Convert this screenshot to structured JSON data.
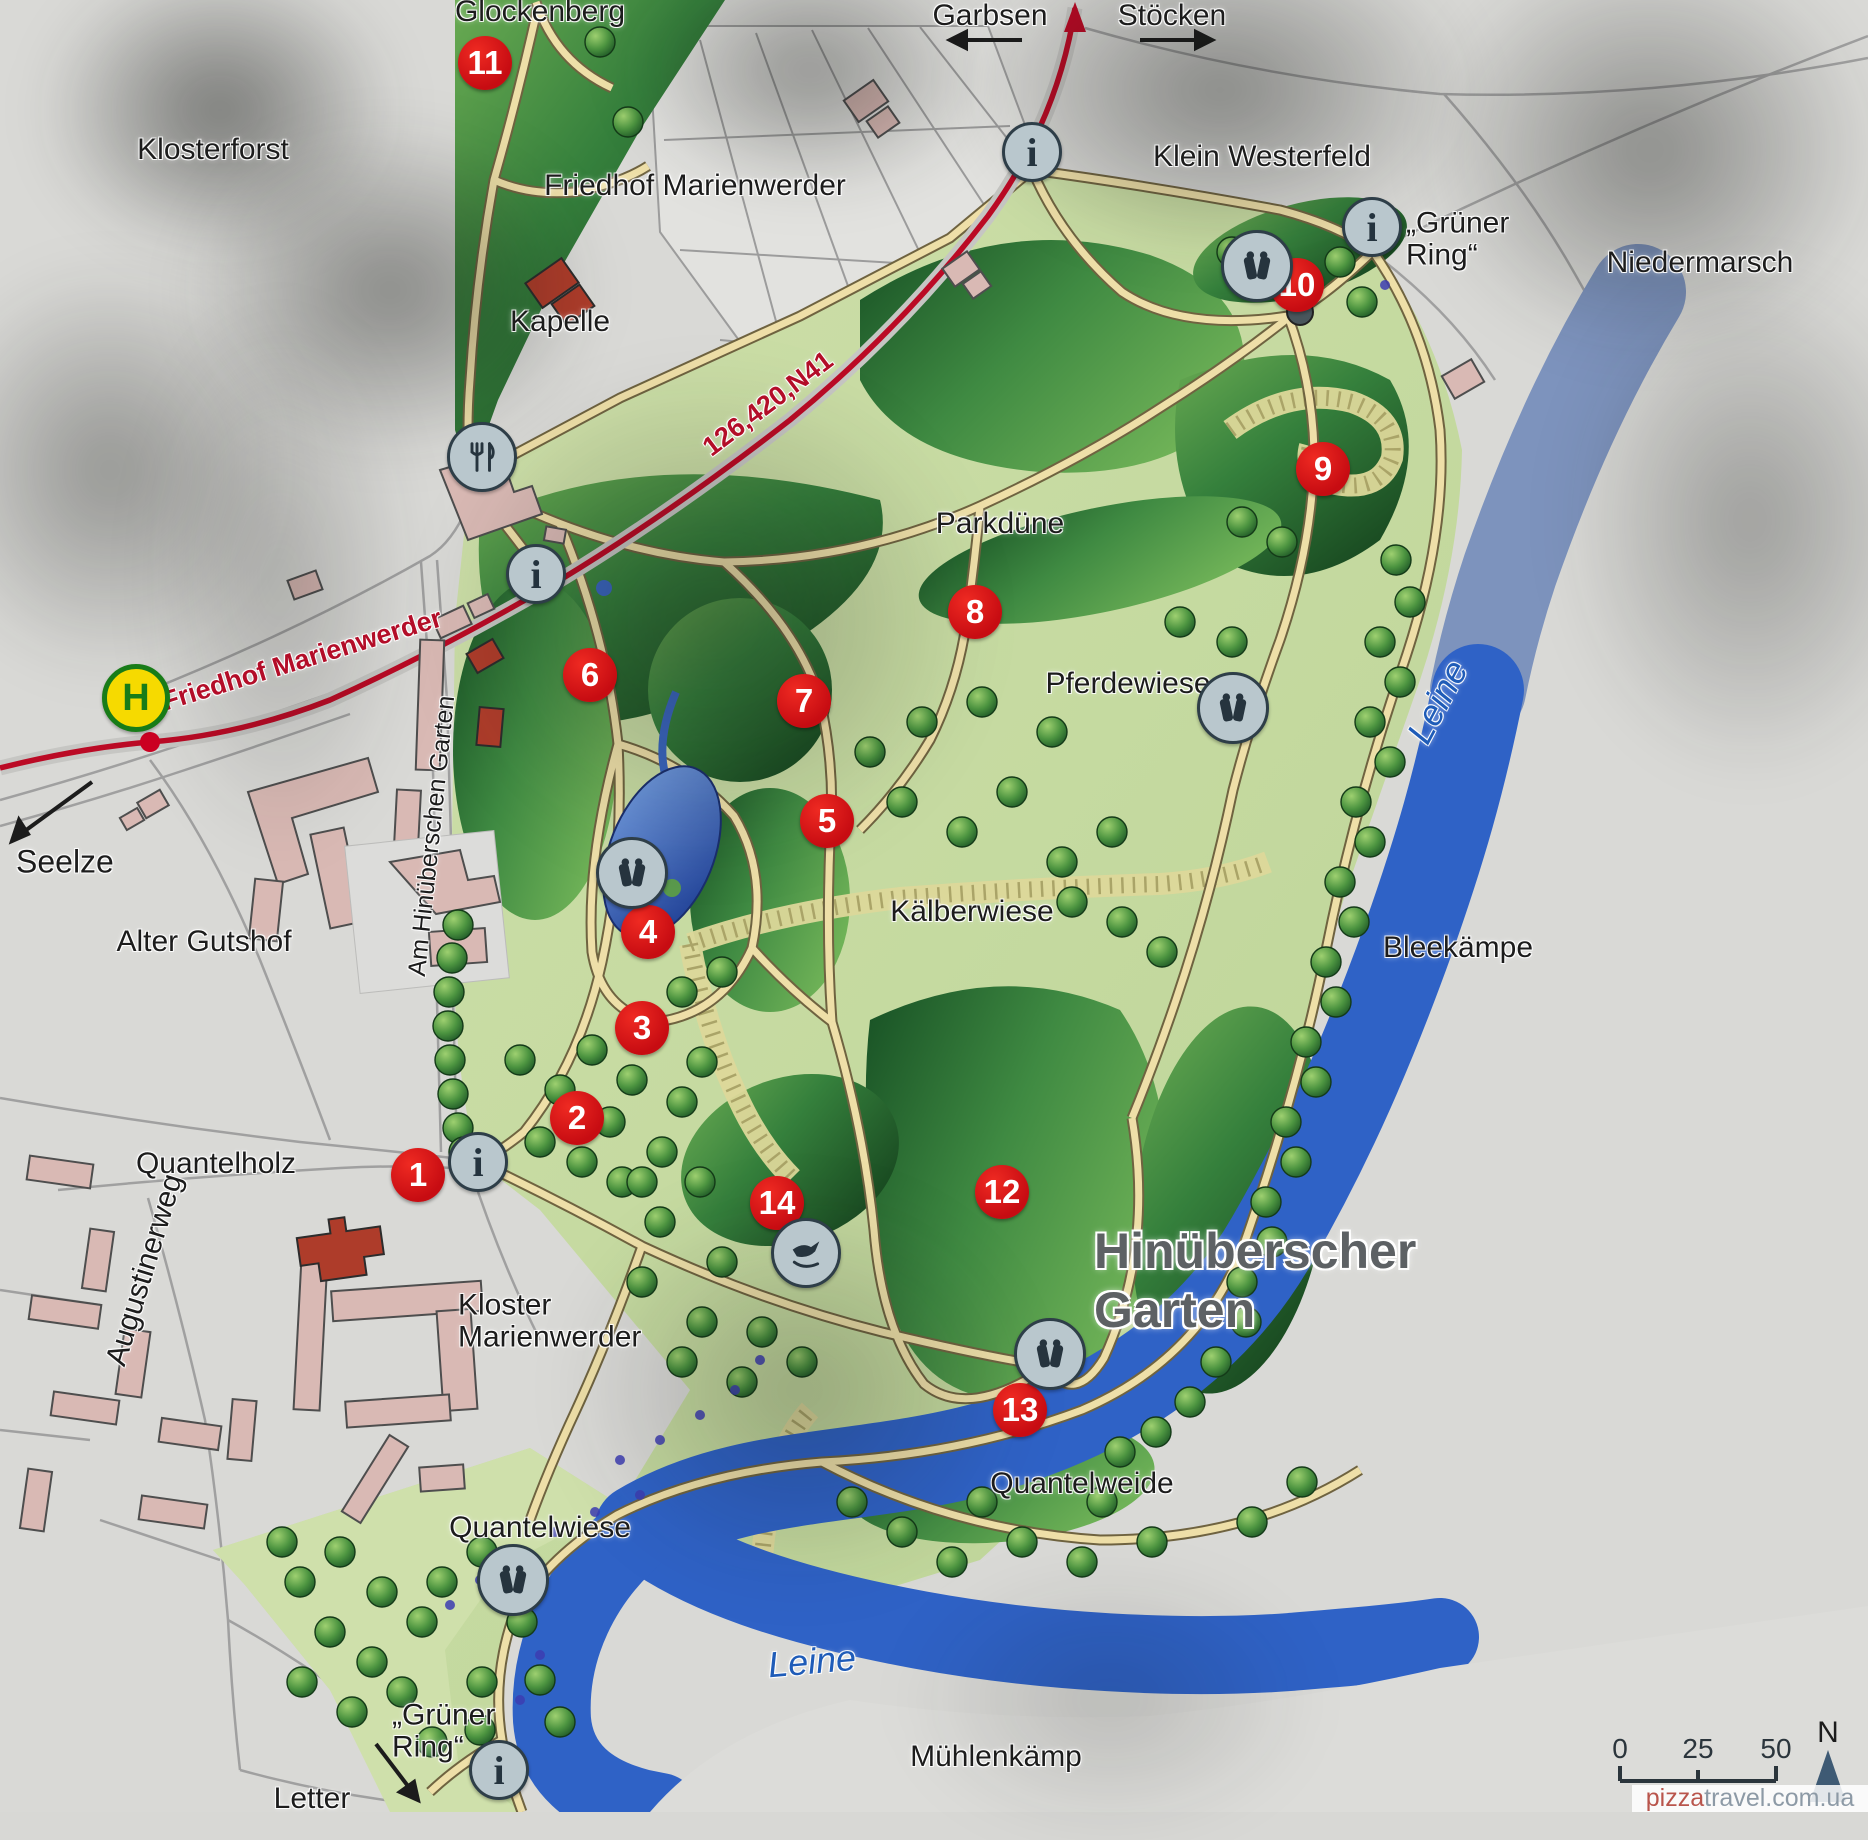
{
  "sign": {
    "title_line1": "Hinüberscher",
    "title_line2": "Garten"
  },
  "labels": [
    {
      "id": "glockenberg",
      "text": "Glockenberg",
      "x": 540,
      "y": 12
    },
    {
      "id": "klosterforst",
      "text": "Klosterforst",
      "x": 213,
      "y": 150
    },
    {
      "id": "friedhof-marienwerder-area",
      "text": "Friedhof Marienwerder",
      "x": 695,
      "y": 186
    },
    {
      "id": "kapelle",
      "text": "Kapelle",
      "x": 560,
      "y": 322
    },
    {
      "id": "garbsen",
      "text": "Garbsen",
      "x": 990,
      "y": 16
    },
    {
      "id": "stoecken",
      "text": "Stöcken",
      "x": 1172,
      "y": 16
    },
    {
      "id": "klein-westerfeld",
      "text": "Klein Westerfeld",
      "x": 1262,
      "y": 157
    },
    {
      "id": "gruener-ring-north",
      "text": "„Grüner\nRing“",
      "x": 1406,
      "y": 240,
      "align": "left"
    },
    {
      "id": "niedermarsch",
      "text": "Niedermarsch",
      "x": 1700,
      "y": 263
    },
    {
      "id": "parkduene",
      "text": "Parkdüne",
      "x": 1000,
      "y": 524
    },
    {
      "id": "pferdewiese",
      "text": "Pferdewiese",
      "x": 1128,
      "y": 684
    },
    {
      "id": "kaelberwiese",
      "text": "Kälberwiese",
      "x": 972,
      "y": 912
    },
    {
      "id": "bleekaempe",
      "text": "Bleekämpe",
      "x": 1458,
      "y": 948
    },
    {
      "id": "leine-east",
      "text": "Leine",
      "x": 1438,
      "y": 702,
      "cls": "water",
      "rot": -62
    },
    {
      "id": "leine-south",
      "text": "Leine",
      "x": 812,
      "y": 1662,
      "cls": "water",
      "rot": -5
    },
    {
      "id": "quantelweide",
      "text": "Quantelweide",
      "x": 1082,
      "y": 1484
    },
    {
      "id": "quantelwiese",
      "text": "Quantelwiese",
      "x": 540,
      "y": 1528
    },
    {
      "id": "gruener-ring-south",
      "text": "„Grüner\nRing“",
      "x": 392,
      "y": 1732,
      "align": "left"
    },
    {
      "id": "letter",
      "text": "Letter",
      "x": 312,
      "y": 1799
    },
    {
      "id": "muehlenkaemp",
      "text": "Mühlenkämp",
      "x": 996,
      "y": 1757
    },
    {
      "id": "seelze",
      "text": "Seelze",
      "x": 16,
      "y": 862,
      "align": "left",
      "size": 32
    },
    {
      "id": "alter-gutshof",
      "text": "Alter Gutshof",
      "x": 204,
      "y": 942
    },
    {
      "id": "quantelholz",
      "text": "Quantelholz",
      "x": 216,
      "y": 1164
    },
    {
      "id": "augustinerweg",
      "text": "Augustinerweg",
      "x": 145,
      "y": 1270,
      "rot": -73
    },
    {
      "id": "am-hinueberschen-garten",
      "text": "Am Hinüberschen Garten",
      "x": 432,
      "y": 836,
      "cls": "sm",
      "rot": -84
    },
    {
      "id": "kloster-marienwerder",
      "text": "Kloster\nMarienwerder",
      "x": 458,
      "y": 1322,
      "align": "left"
    },
    {
      "id": "road-number",
      "text": "126,420,N41",
      "x": 768,
      "y": 404,
      "cls": "street",
      "rot": -37
    },
    {
      "id": "friedhof-marienwerder-street",
      "text": "Friedhof Marienwerder",
      "x": 302,
      "y": 660,
      "cls": "street",
      "rot": -17
    }
  ],
  "markers": [
    {
      "n": "1",
      "x": 418,
      "y": 1175
    },
    {
      "n": "2",
      "x": 577,
      "y": 1118
    },
    {
      "n": "3",
      "x": 642,
      "y": 1028
    },
    {
      "n": "4",
      "x": 648,
      "y": 932
    },
    {
      "n": "5",
      "x": 827,
      "y": 821
    },
    {
      "n": "6",
      "x": 590,
      "y": 675
    },
    {
      "n": "7",
      "x": 804,
      "y": 701
    },
    {
      "n": "8",
      "x": 975,
      "y": 612
    },
    {
      "n": "9",
      "x": 1323,
      "y": 469
    },
    {
      "n": "10",
      "x": 1297,
      "y": 285
    },
    {
      "n": "11",
      "x": 485,
      "y": 63
    },
    {
      "n": "12",
      "x": 1002,
      "y": 1192
    },
    {
      "n": "13",
      "x": 1020,
      "y": 1410
    },
    {
      "n": "14",
      "x": 777,
      "y": 1203
    }
  ],
  "icons": [
    {
      "id": "info-garbsen-junction",
      "type": "info",
      "x": 1032,
      "y": 152,
      "glyph": "i"
    },
    {
      "id": "info-gruener-ring-north",
      "type": "info",
      "x": 1372,
      "y": 227,
      "glyph": "i"
    },
    {
      "id": "info-park-northwest",
      "type": "info",
      "x": 536,
      "y": 574,
      "glyph": "i"
    },
    {
      "id": "info-main-entrance",
      "type": "info",
      "x": 478,
      "y": 1162,
      "glyph": "i"
    },
    {
      "id": "info-gruener-ring-south",
      "type": "info",
      "x": 499,
      "y": 1770,
      "glyph": "i"
    },
    {
      "id": "binoculars-north",
      "type": "binoculars",
      "x": 1257,
      "y": 266
    },
    {
      "id": "binoculars-pferdewiese",
      "type": "binoculars",
      "x": 1233,
      "y": 708
    },
    {
      "id": "binoculars-lake",
      "type": "binoculars",
      "x": 632,
      "y": 873
    },
    {
      "id": "binoculars-south",
      "type": "binoculars",
      "x": 1050,
      "y": 1354
    },
    {
      "id": "binoculars-quantelwiese",
      "type": "binoculars",
      "x": 513,
      "y": 1580
    },
    {
      "id": "restaurant",
      "type": "restaurant",
      "x": 482,
      "y": 457
    },
    {
      "id": "bird-feeding",
      "type": "bird",
      "x": 806,
      "y": 1253
    },
    {
      "id": "bus-stop-h",
      "type": "bus-stop",
      "x": 136,
      "y": 698,
      "glyph": "H"
    }
  ],
  "scale_bar": {
    "ticks": [
      "0",
      "25",
      "50"
    ],
    "north_label": "N"
  },
  "watermark": {
    "prefix": "pizza",
    "suffix": "travel.com.ua"
  }
}
